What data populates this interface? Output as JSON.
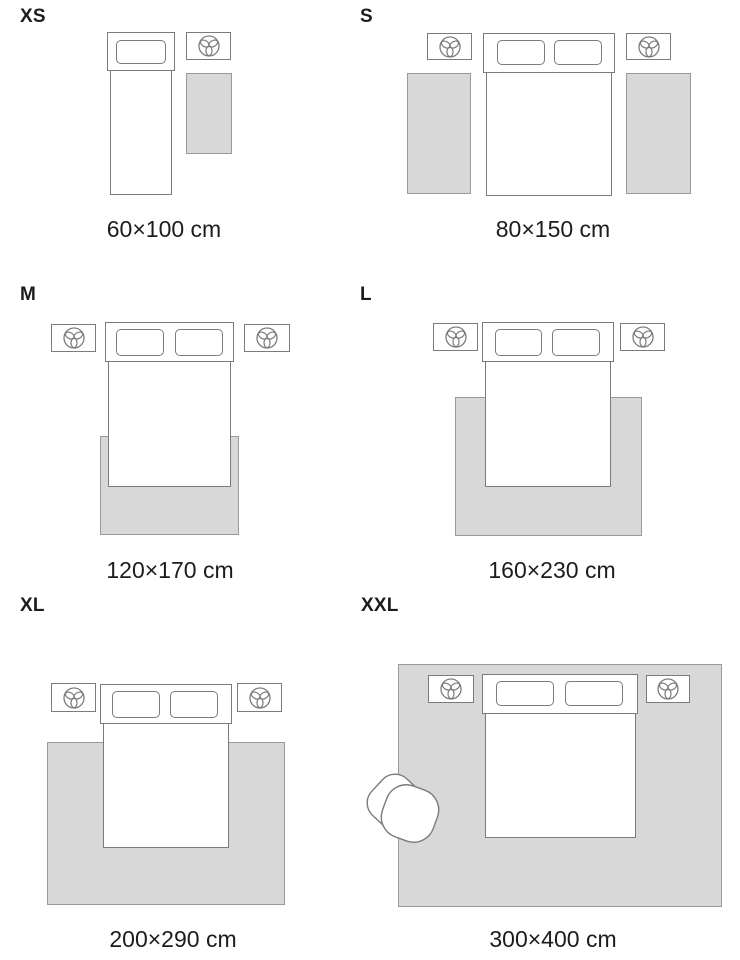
{
  "panels": {
    "xs": {
      "label": "XS",
      "size": "60×100 cm"
    },
    "s": {
      "label": "S",
      "size": "80×150 cm"
    },
    "m": {
      "label": "M",
      "size": "120×170 cm"
    },
    "l": {
      "label": "L",
      "size": "160×230 cm"
    },
    "xl": {
      "label": "XL",
      "size": "200×290 cm"
    },
    "xxl": {
      "label": "XXL",
      "size": "300×400 cm"
    }
  },
  "colors": {
    "background": "#ffffff",
    "rug_fill": "#d8d8d8",
    "rug_border": "#9a9a9a",
    "furniture_border": "#7b7b7b",
    "furniture_fill": "#ffffff",
    "text": "#1c1c1c"
  },
  "icons": {
    "nightstand_icon": "plant-icon (trefoil plant, top view, inside circle)"
  }
}
